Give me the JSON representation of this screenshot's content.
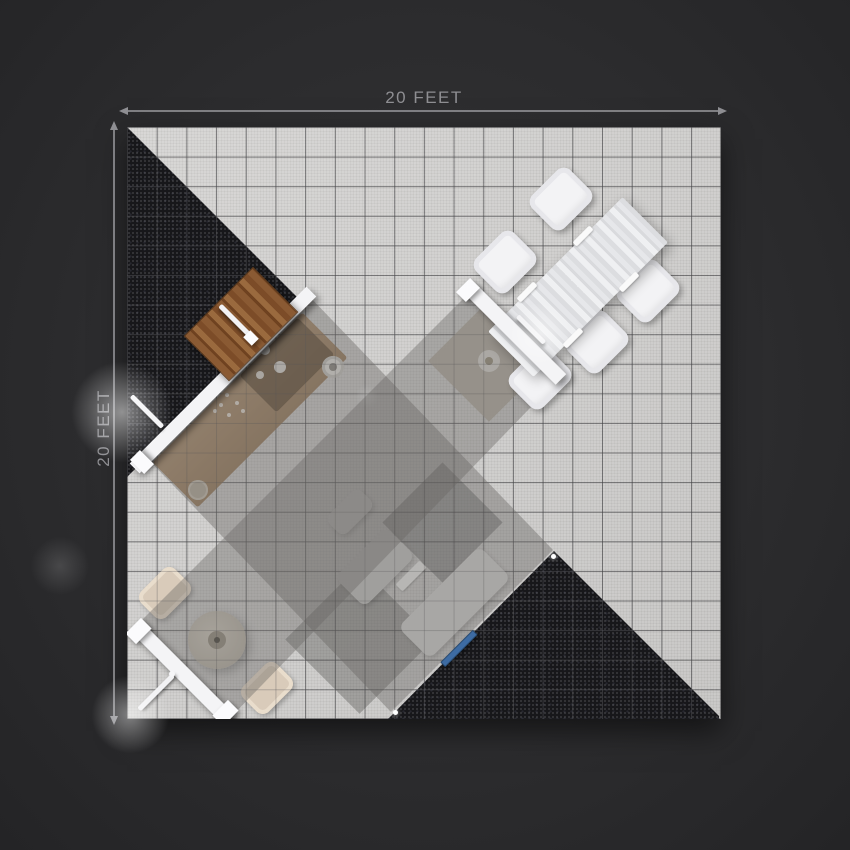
{
  "annotations": {
    "top_dimension_label": "20 FEET",
    "left_dimension_label": "20 FEET"
  },
  "floor": {
    "width_feet": 20,
    "depth_feet": 20,
    "grid_cols": 20,
    "grid_rows": 20
  },
  "colors": {
    "background": "#2c2c2e",
    "floor-tile": "#d6d5d3",
    "carpet": "#17171a",
    "canopy": "#686663",
    "wall-white": "#f4f4f6",
    "wood-door": "#8a5a33",
    "counter-wood": "#a98a68",
    "table-white": "#ebebed",
    "chair-white": "#f3f3f5",
    "chair-beige": "#d9cbba",
    "accent-blue": "#3d6ba3",
    "dimension-gray": "#8e8e92"
  },
  "scene": {
    "objects": [
      {
        "name": "carpet-triangle-top-left",
        "description": "black speckled carpet triangle in upper-left corner"
      },
      {
        "name": "carpet-triangle-bottom-right",
        "description": "black speckled carpet triangle at bottom-right"
      },
      {
        "name": "canopy-cross",
        "description": "translucent gray diagonal canopy bands crossing the floor"
      },
      {
        "name": "wood-door",
        "description": "brown wooden door with white lever handle on diagonal wall"
      },
      {
        "name": "kitchen-counter",
        "description": "counter with sink, knobs and drain dots seen through canopy"
      },
      {
        "name": "dining-table",
        "description": "white wood-grain table rotated 45 degrees with five white chairs"
      },
      {
        "name": "round-table",
        "description": "round pedestal table with two beige chairs under canopy"
      },
      {
        "name": "partition-walls",
        "description": "three white diagonal partition walls with lever handles"
      },
      {
        "name": "under-canopy-tables",
        "description": "small light tables and dark patches under canopy near bottom"
      },
      {
        "name": "blue-mat",
        "description": "small blue strip on black carpet"
      }
    ]
  }
}
